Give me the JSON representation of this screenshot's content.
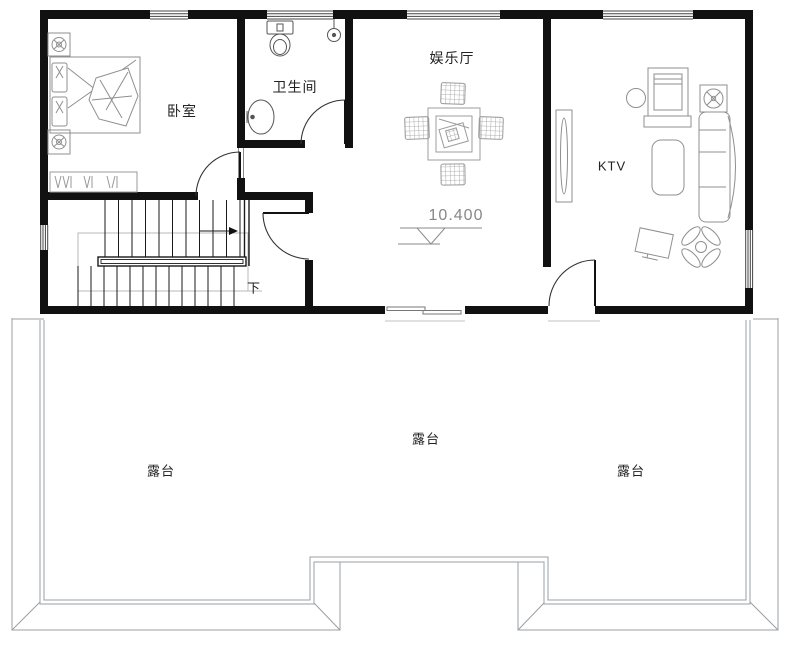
{
  "rooms": {
    "bedroom": {
      "label": "卧室"
    },
    "bathroom": {
      "label": "卫生间"
    },
    "entertainment_hall": {
      "label": "娱乐厅"
    },
    "ktv": {
      "label": "KTV"
    }
  },
  "stairs": {
    "direction_label": "下"
  },
  "elevation_marker": {
    "value": "10.400"
  },
  "terraces": [
    {
      "label": "露台"
    },
    {
      "label": "露台"
    },
    {
      "label": "露台"
    }
  ],
  "colors": {
    "wall": "#111111",
    "furniture_line": "#8f8f8f",
    "fixture_line": "#555555",
    "stair_line": "#1a1a1a",
    "terrace_line": "#9aa0a4",
    "guide_line": "#b8b8b8",
    "text": "#222222",
    "elevation_text": "#878787",
    "background": "#ffffff"
  },
  "symbols": [
    "double-bed",
    "pillow",
    "quilt",
    "nightstand-lamp",
    "wardrobe",
    "toilet",
    "floor-drain",
    "washbasin",
    "mahjong-table",
    "mahjong-chair",
    "door-swing",
    "window",
    "staircase",
    "handrail",
    "direction-arrow",
    "tv-cabinet",
    "karaoke-screen",
    "stool",
    "speaker",
    "curved-sofa",
    "coffee-table",
    "display-screen",
    "plant",
    "sliding-door",
    "elevation-symbol"
  ]
}
